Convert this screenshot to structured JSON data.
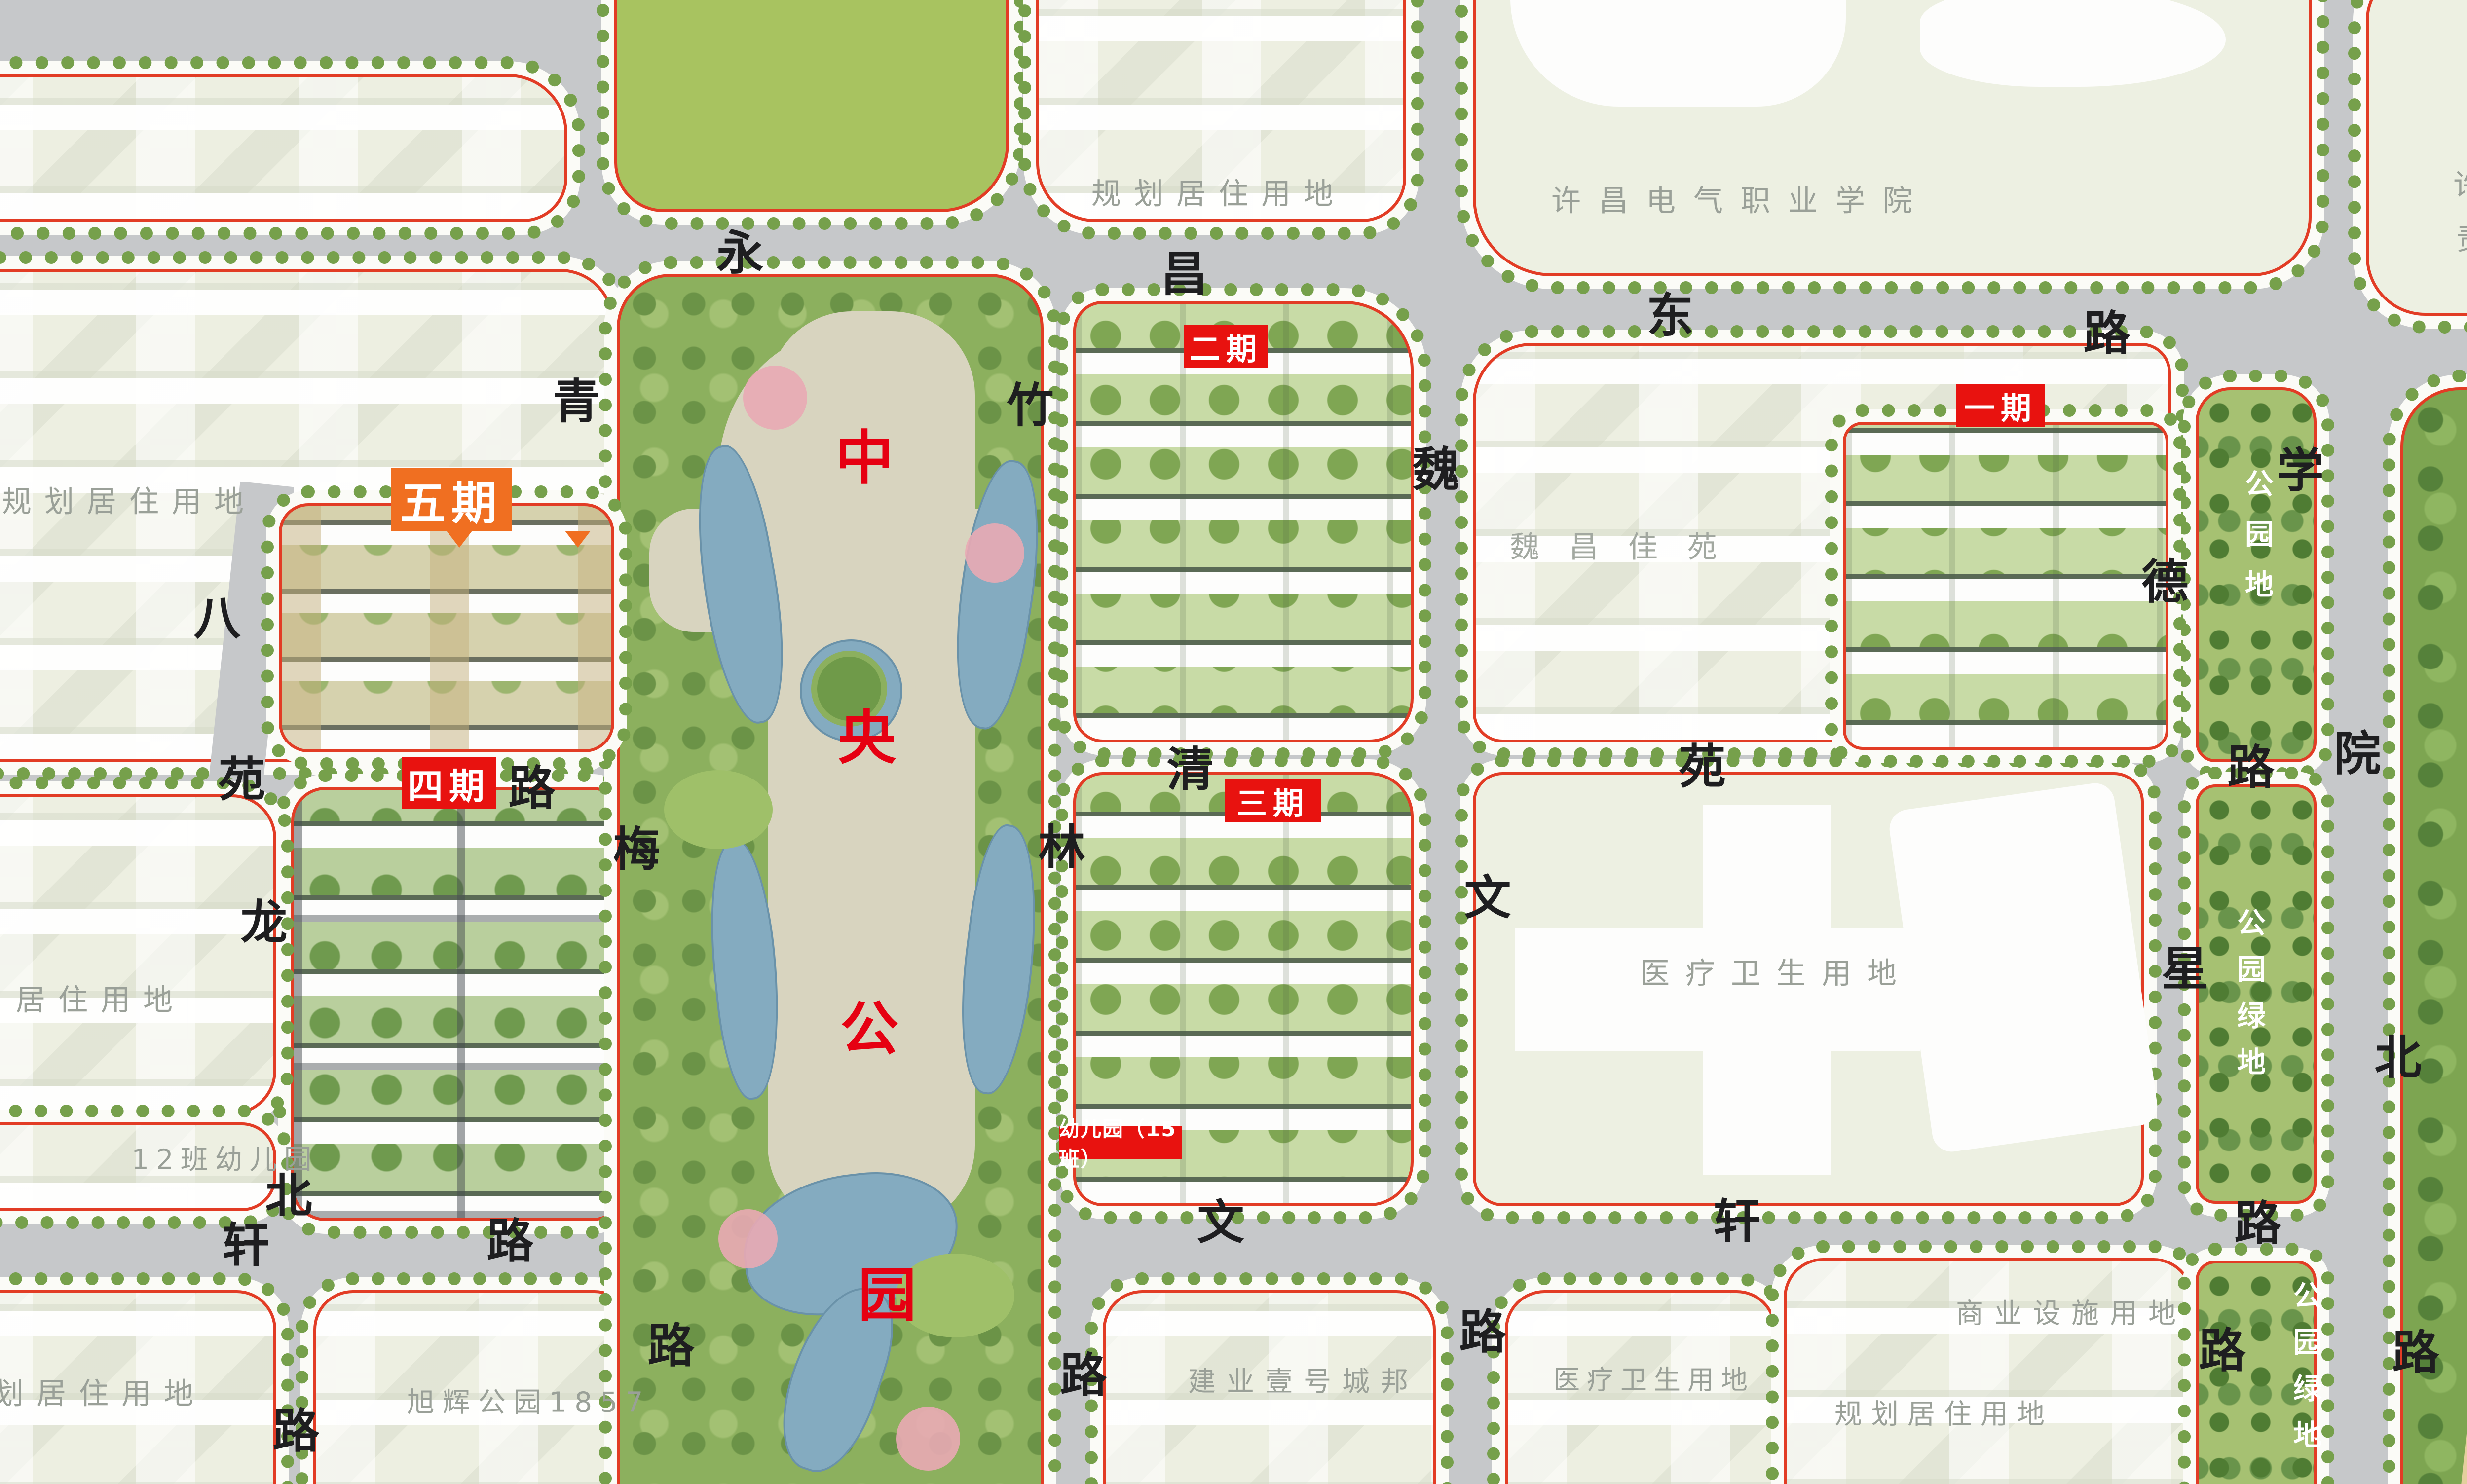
{
  "colors": {
    "phase_tag_red": "#e8120f",
    "phase5_tag_orange": "#f06f21",
    "park_char_red": "#e60012",
    "road_background_gray": "#c6c8ca",
    "parcel_label_gray": "#9aa098",
    "parcel_boundary_red": "#e23c25"
  },
  "roads": {
    "yongchang_east": {
      "name": "永昌东路",
      "chars": [
        "永",
        "昌",
        "东",
        "路"
      ]
    },
    "balong_north": {
      "name": "八龙北路",
      "chars": [
        "八",
        "龙",
        "北",
        "路"
      ]
    },
    "yuan": {
      "name": "苑路",
      "chars": [
        "苑",
        "路"
      ]
    },
    "qingmei": {
      "name": "青梅路",
      "chars": [
        "青",
        "梅",
        "路"
      ]
    },
    "zhulin": {
      "name": "竹林路",
      "chars": [
        "竹",
        "林",
        "路"
      ]
    },
    "weiwen": {
      "name": "魏文路",
      "chars": [
        "魏",
        "文",
        "路"
      ]
    },
    "qingyuan": {
      "name": "清苑路",
      "chars": [
        "清",
        "苑",
        "路"
      ]
    },
    "wenxuan": {
      "name": "文轩路",
      "chars_west": [
        "轩",
        "路"
      ],
      "chars_east": [
        "文",
        "轩",
        "路"
      ]
    },
    "dexing": {
      "name": "德星路",
      "chars": [
        "德",
        "星",
        "路"
      ]
    },
    "xueyuan_north": {
      "name": "学院北路",
      "chars": [
        "学",
        "院",
        "北",
        "路"
      ]
    }
  },
  "parcels": {
    "planned_residential": "规划居住用地",
    "college": "许昌电气职业学院",
    "tobacco_line1": "许昌烟草机械",
    "tobacco_line2": "责任有限公司",
    "weichang_jiayuan": "魏昌佳苑",
    "medical": "医疗卫生用地",
    "kindergarten_12": "12班幼儿园",
    "xuhui_park": "旭辉公园1857",
    "jianye": "建业壹号城邦",
    "commercial": "商业设施用地",
    "park_land": "公园地",
    "park_green": "公园绿地"
  },
  "phases": {
    "p1": "一期",
    "p2": "二期",
    "p3": "三期",
    "p4": "四期",
    "p5": "五期"
  },
  "tags": {
    "kindergarten_15": "幼儿园（15班）"
  },
  "central_park": {
    "name": "中央公园",
    "chars": [
      "中",
      "央",
      "公",
      "园"
    ]
  },
  "lake_park": {
    "name": "鹿鸣湖",
    "chars": [
      "鹿",
      "鸣",
      "湖"
    ]
  }
}
